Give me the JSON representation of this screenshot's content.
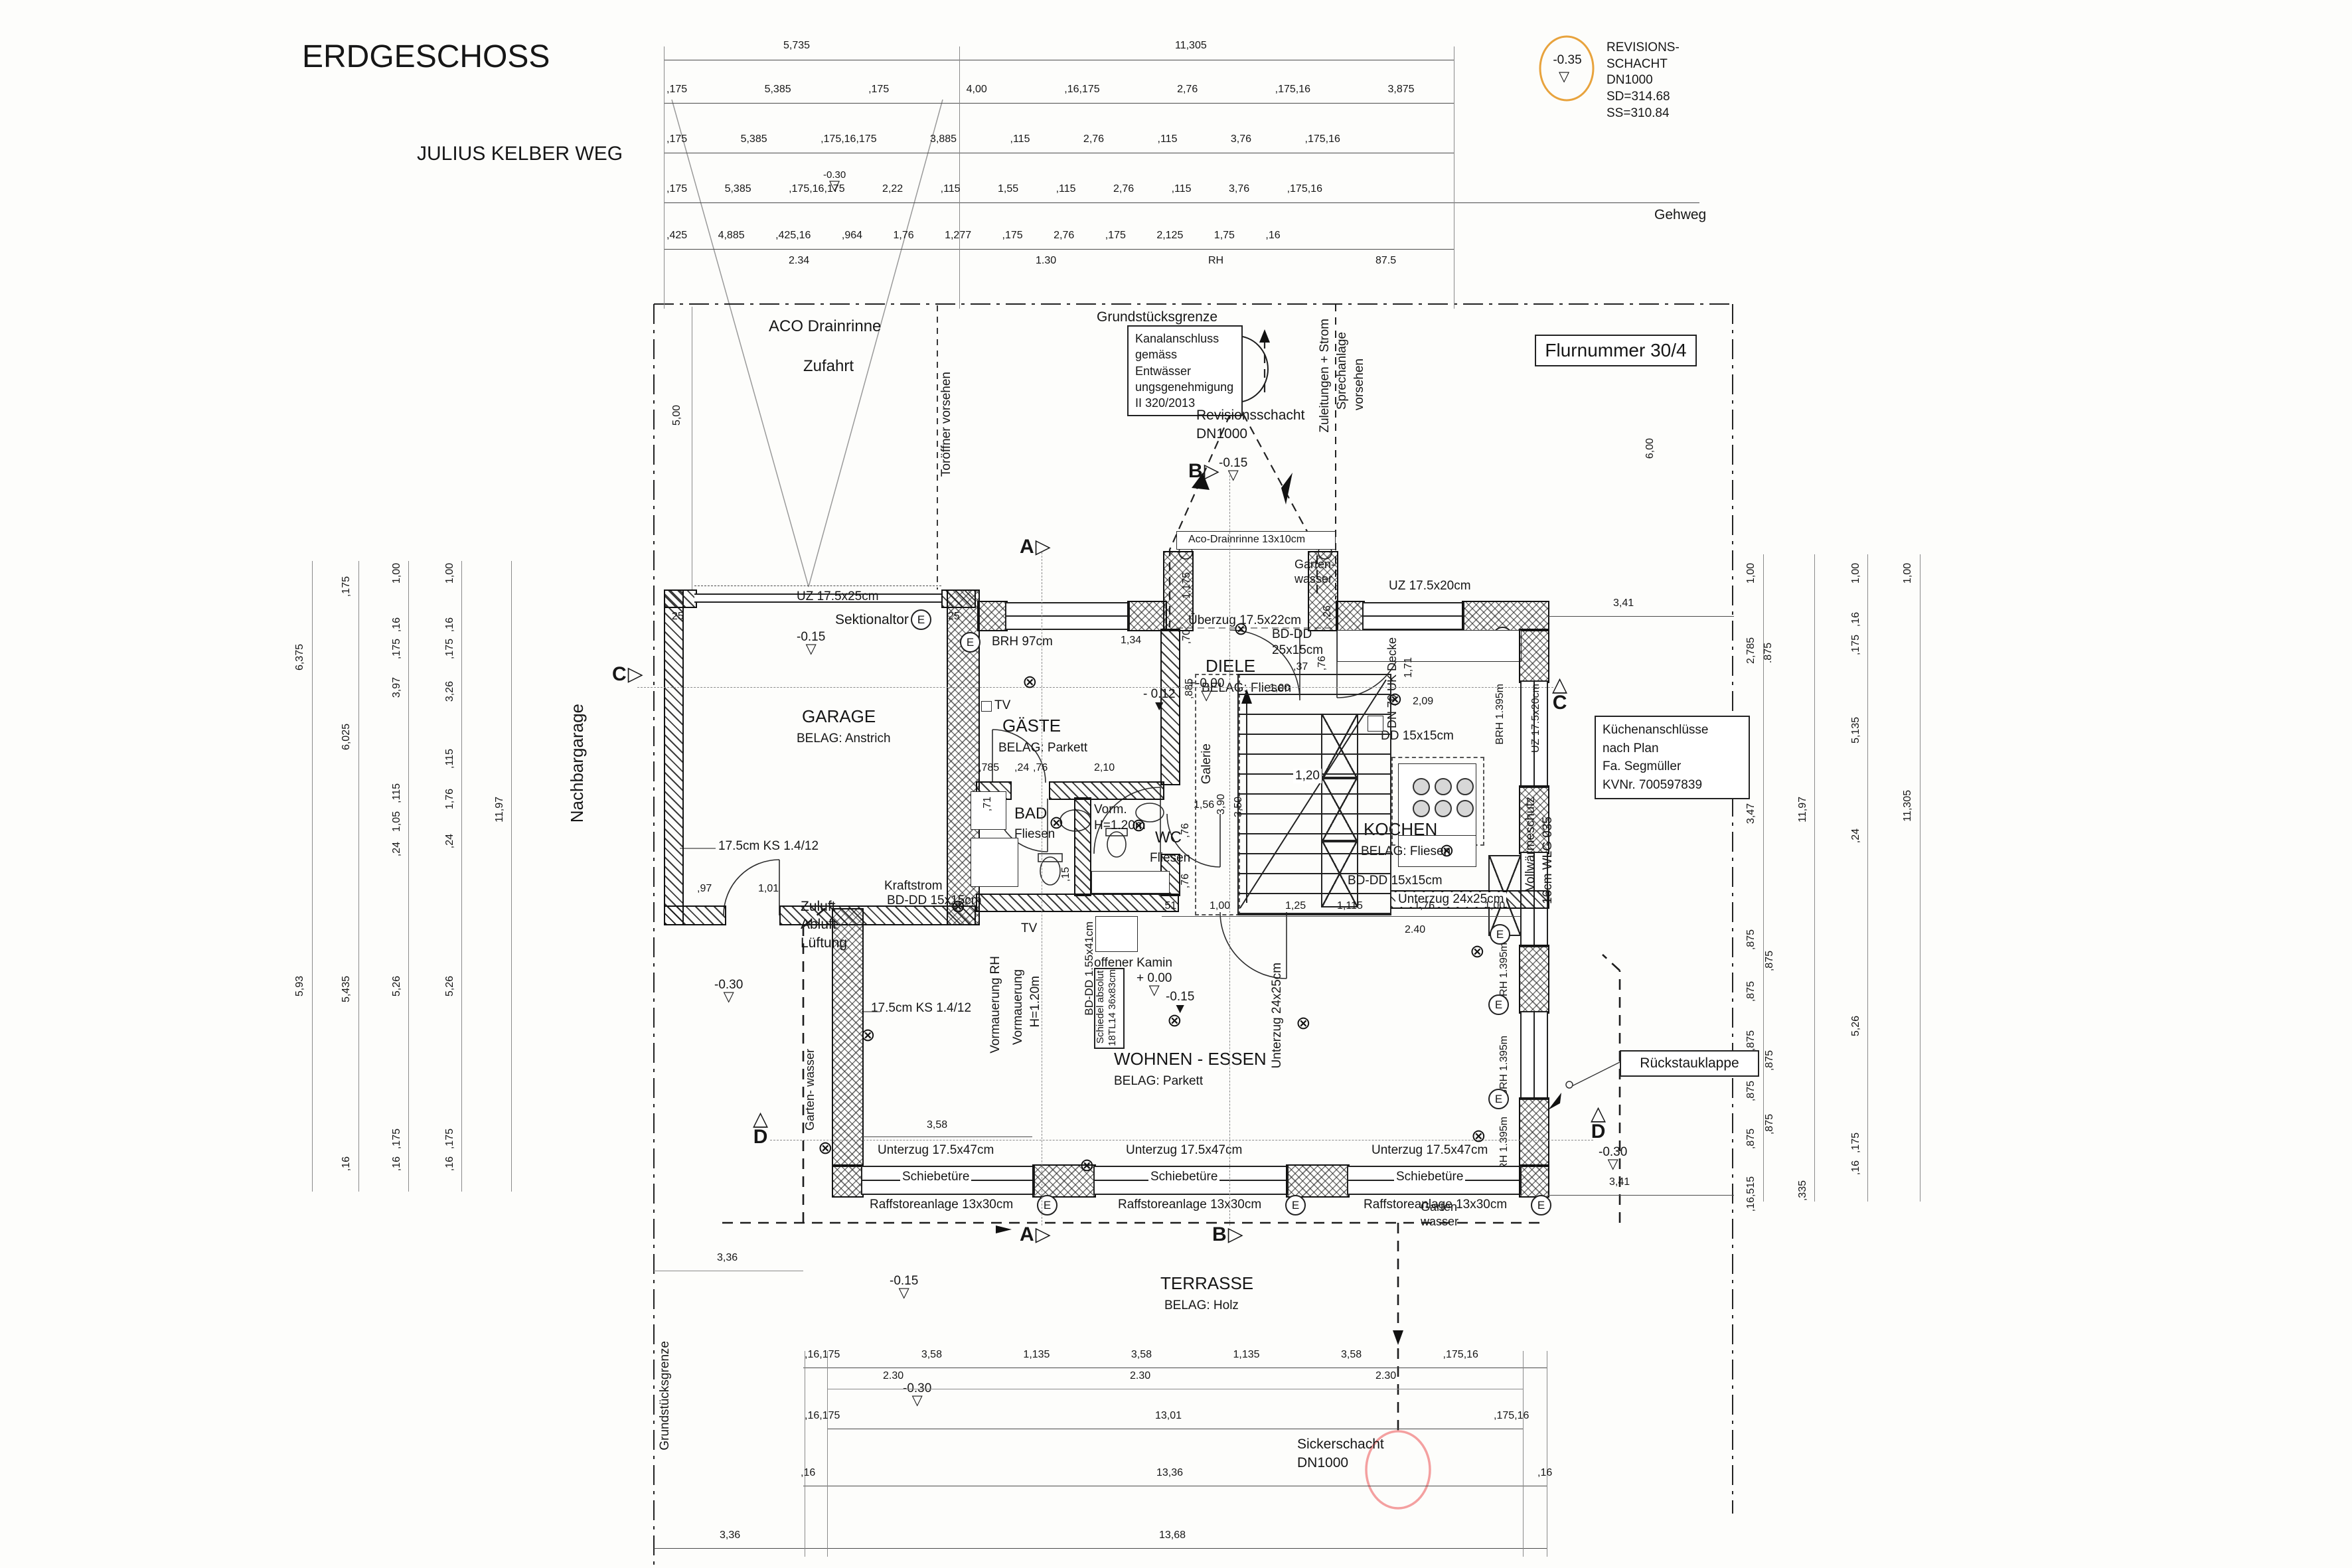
{
  "colors": {
    "accent_orange": "#e8a33d",
    "accent_red": "#f4a0a0",
    "ink": "#1c1c1c",
    "dimline": "#555555"
  },
  "icons": {
    "lamp": "⊗",
    "tri_open": "▽",
    "tri_filled": "▼",
    "tri_right": "▷",
    "tri_up": "△",
    "arrow_right": "→",
    "arrow_down": "↓"
  },
  "header": {
    "title": "ERDGESCHOSS",
    "subtitle": "JULIUS KELBER WEG"
  },
  "site": {
    "flurnummer": "Flurnummer 30/4",
    "gehweg": "Gehweg",
    "grundstuecksgrenze": "Grundstücksgrenze",
    "nachbargarage": "Nachbargarage",
    "zufahrt": "Zufahrt",
    "aco_drainrinne": "ACO Drainrinne",
    "toroeffner": "Toröffner vorsehen",
    "zuleitungen": [
      "Zuleitungen + Strom",
      "Sprechanlage",
      "vorsehen"
    ],
    "kanalanschluss": [
      "Kanalanschluss",
      "gemäss Entwässer",
      "ungsgenehmigung",
      "II 320/2013"
    ],
    "revisionsschacht": [
      "Revisionsschacht",
      "DN1000"
    ],
    "revision_top": {
      "level": "-0.35",
      "lines": [
        "REVISIONS-",
        "SCHACHT",
        "DN1000",
        "SD=314.68",
        "SS=310.84"
      ]
    },
    "sickerschacht": [
      "Sickerschacht",
      "DN1000"
    ],
    "kuechenanschluesse": [
      "Küchenanschlüsse",
      "nach Plan",
      "Fa. Segmüller",
      "KVNr. 700597839"
    ],
    "rueckstauklappe": "Rückstauklappe"
  },
  "rooms": {
    "garage": {
      "name": "GARAGE",
      "belag": "BELAG: Anstrich"
    },
    "gaeste": {
      "name": "GÄSTE",
      "belag": "BELAG: Parkett"
    },
    "diele": {
      "name": "DIELE",
      "belag": "BELAG: Fliesen"
    },
    "bad": {
      "name": "BAD",
      "belag": "Fliesen"
    },
    "wc": {
      "name": "WC",
      "belag": "Fliesen"
    },
    "kochen": {
      "name": "KOCHEN",
      "belag": "BELAG: Fliesen"
    },
    "wohnen": {
      "name": "WOHNEN - ESSEN",
      "belag": "BELAG: Parkett"
    },
    "terrasse": {
      "name": "TERRASSE",
      "belag": "BELAG: Holz"
    }
  },
  "notes": {
    "sektionaltor": "Sektionaltor",
    "uz_17525": "UZ 17.5x25cm",
    "uz_17520": "UZ 17.5x20cm",
    "uz_17547": "Unterzug 17.5x47cm",
    "unterzug_2425": "Unterzug 24x25cm",
    "ueberzug": "Überzug 17.5x22cm",
    "bddd_2515": [
      "BD-DD",
      "25x15cm"
    ],
    "bddd_1515": "BD-DD 15x15cm",
    "bddd_15541": "BD-DD 1.55x41cm",
    "dd_1515": "DD 15x15cm",
    "dn70": "DN 70 UK Decke",
    "ks": "17.5cm KS 1.4/12",
    "kraftstrom": "Kraftstrom",
    "brh97": "BRH 97cm",
    "brh1395": "BRH 1.395m",
    "schiebetuere": "Schiebetüre",
    "raffstore": "Raffstoreanlage 13x30cm",
    "aco_13x10": "Aco-Drainrinne 13x10cm",
    "vollwaermeschutz": [
      "Vollwärmeschutz",
      "16cm WLG 035"
    ],
    "vormauerung_rh": "Vormauerung RH",
    "vormauerung_h": [
      "Vormauerung",
      "H=1.20m"
    ],
    "vorm": [
      "Vorm.",
      "H=1.20m"
    ],
    "tv": "TV",
    "offener_kamin": "offener Kamin",
    "schiedel": [
      "Schiedel absolut",
      "18TL14 36x83cm"
    ],
    "galerie": "Galerie",
    "zuluft": [
      "Zuluft",
      "Abluft",
      "Lüftung"
    ],
    "gartenwasser": [
      "Garten-",
      "wasser"
    ],
    "e": "E"
  },
  "levels": {
    "p000": "+ 0.00",
    "pm000": "+-0.00",
    "m012": "- 0.12",
    "m015": "-0.15",
    "m030": "-0.30",
    "m035": "-0.35"
  },
  "sections": {
    "a": "A",
    "b": "B",
    "c": "C",
    "d": "D"
  },
  "dims": {
    "top0a": "5,735",
    "top0b": "11,305",
    "top1": [
      ",175",
      "5,385",
      ",175",
      "4,00",
      ",16,175",
      "2,76",
      ",175,16",
      "3,875"
    ],
    "top2": [
      ",175",
      "5,385",
      ",175,16,175",
      "3,885",
      ",115",
      "2,76",
      ",115",
      "3,76",
      ",175,16"
    ],
    "top3": [
      ",175",
      "5,385",
      ",175,16,175",
      "2,22",
      ",115",
      "1,55",
      ",115",
      "2,76",
      ",115",
      "3,76",
      ",175,16"
    ],
    "top4": [
      ",425",
      "4,885",
      ",425,16",
      ",964",
      "1,76",
      "1,277",
      ",175",
      "2,76",
      ",175",
      "2,125",
      "1,75",
      ",16"
    ],
    "sub234": "2.34",
    "sub130": "1.30",
    "subRH": "RH",
    "sub875": "87.5",
    "bottom1": [
      ",16,175",
      "3,58",
      "1,135",
      "3,58",
      "1,135",
      "3,58",
      ",175,16"
    ],
    "sub230": "2.30",
    "bottom2a": ",16,175",
    "bottom2b": "13,01",
    "bottom2c": ",175,16",
    "bottom3a": ",16",
    "bottom3b": "13,36",
    "bottom3c": ",16",
    "bottom4": "13,68",
    "left": {
      "a": "6,375",
      "b": "5,93",
      "c": ",175",
      "d": "6,025",
      "e": "5,435",
      "f": "1,00",
      "g": ",16",
      "h": ",175",
      "i": "3,97",
      "j": ",115",
      "k": "1,05",
      "l": ",24",
      "m": "5,26",
      "n": "3,26",
      "o": "1,76",
      "p": "11,97",
      "q": ",16"
    },
    "right": {
      "a": "1,00",
      "b": "2,785",
      "b2": ".875",
      "c": "3,47",
      "d": ",875",
      "e": ",16,515",
      "f": ",335",
      "g": "11,97",
      "h": ",24",
      "i": "5,135",
      "j": "5,26",
      "k": "11,305",
      "l": ",16",
      "m": ",175"
    },
    "plan": {
      "d500": "5,00",
      "d600": "6,00",
      "d341": "3,41",
      "d25": "25",
      "d97": ",97",
      "d101": "1,01",
      "d134": "1,34",
      "d1175": "1,175",
      "d70": ",70",
      "d885": ",885",
      "d37": ",37",
      "d26": ",26",
      "d76": ",76",
      "d100": "1,00",
      "d785": ",785",
      "d24": ",24",
      "d210": "2,10",
      "d71": ",71",
      "d15": ",15",
      "d156": "1,56",
      "d120": "1,20",
      "d390": "3,90",
      "d350": "3,50",
      "d171": "1,71",
      "d209": "2,09",
      "d51": ",51",
      "d125": "1,25",
      "d1115": "1,115",
      "d176": "1,76",
      "d240": "2.40",
      "d358": "3,58",
      "d336": "3,36"
    }
  }
}
